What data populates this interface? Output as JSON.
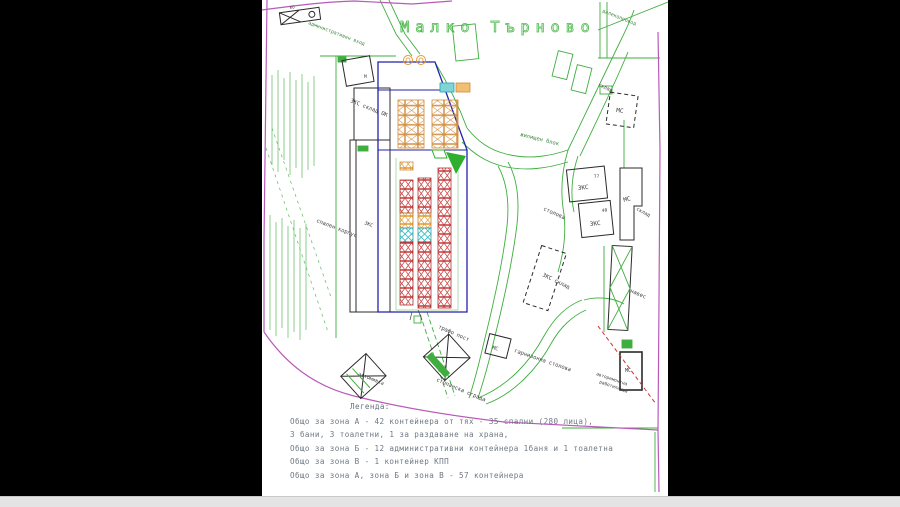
{
  "title": "Малко Търново",
  "colors": {
    "paper": "#ffffff",
    "letterbox": "#000000",
    "boundary_magenta": "#b85ab8",
    "zone_blue": "#2222aa",
    "line_green": "#3fae3f",
    "container_red": "#c43c3c",
    "container_orange": "#e09a30",
    "container_cyan": "#38b8c0",
    "building_black": "#2b2b2b",
    "legend_text": "#6e7884",
    "title_green": "#49b849"
  },
  "labels": {
    "admin_entrance": "административен вход",
    "powerline": "далекопровод",
    "sklad_top": "склад",
    "ms_top": "МС",
    "m_mark": "М",
    "ko_mark": "КО",
    "zhilishten_blok": "жилищен блок",
    "zks_sklad_ok": "ЗКС  склад  ОК",
    "spalen_korpus": "спален корпус",
    "zks_left": "ЗКС",
    "stolova": "столова",
    "zks1": "ЗКС",
    "zks1_num": "77",
    "zks2": "ЗКС",
    "zks2_num": "40",
    "ms_right": "МС",
    "sklad_right": "склад",
    "naves": "навес",
    "zks_sklad": "ЗКС склад",
    "trafo_post": "трафо пост",
    "avtomivka": "автомивка",
    "stopanska_sgrada": "стопанска сграда",
    "garnizonna_stolova": "гарнизонна столова",
    "remont_line1": "авторемонтна",
    "remont_line2": "работилница",
    "ms_bottom1": "МС",
    "ms_bottom2": "МС"
  },
  "legend": {
    "heading": "Легенда:",
    "lines": [
      "Общо за зона А - 42 контейнера от тях - 35 спални (280 лица),",
      "3 бани, 3 тоалетни, 1 за раздаване на храна,",
      "Общо за зона Б - 12 административни контейнера 1баня и 1 тоалетна",
      "Общо за зона В - 1 контейнер КПП",
      "Общо за зона А, зона Б и зона В - 57 контейнера"
    ]
  }
}
